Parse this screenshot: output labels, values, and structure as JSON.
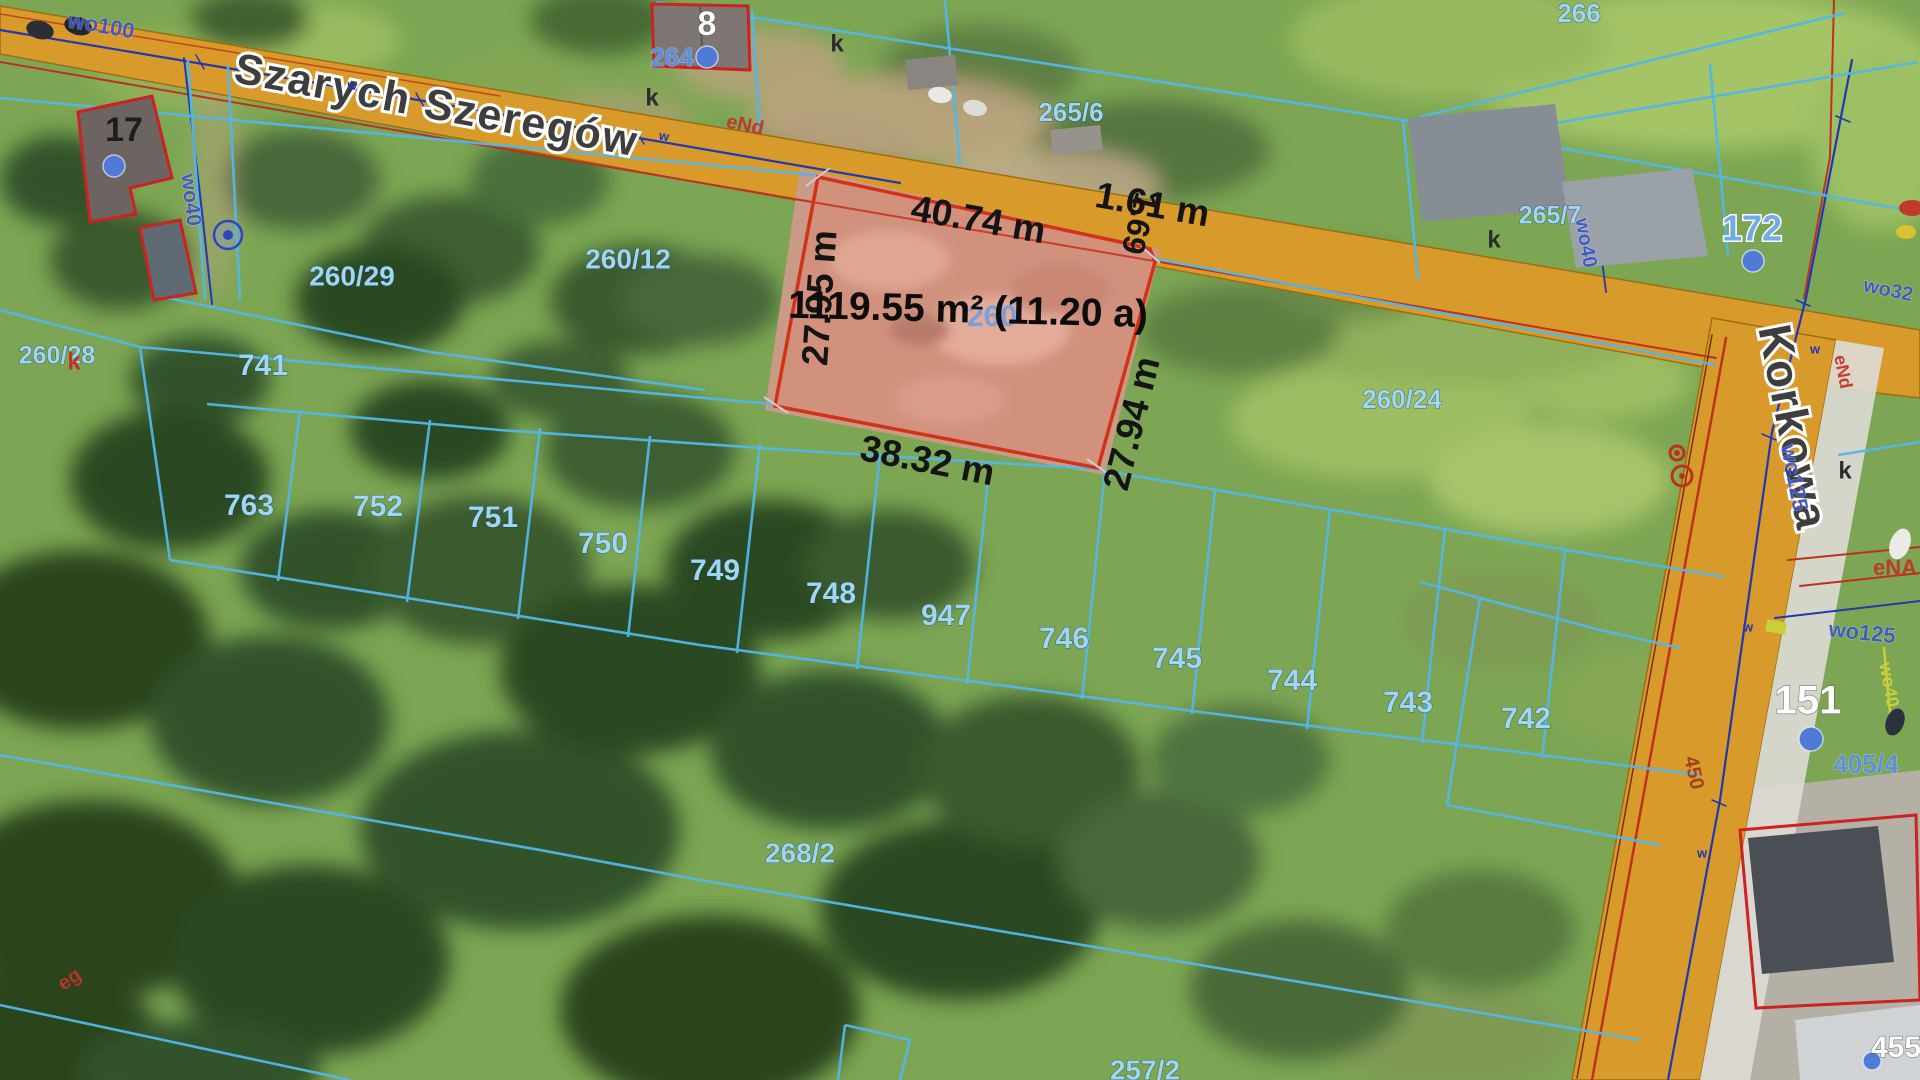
{
  "map": {
    "kind": "cadastral-aerial-map",
    "streets": [
      {
        "name": "Szarych Szeregów"
      },
      {
        "name": "Korkowa"
      }
    ],
    "highlight_parcel": {
      "area_label": "1119.55 m² (11.20 a)",
      "edge_lengths": [
        "40.74 m",
        "1.61 m",
        "1.69",
        "27.95 m",
        "27.94 m",
        "38.32 m"
      ]
    },
    "parcel_numbers": [
      "260/29",
      "260/12",
      "260/28",
      "260/24",
      "741",
      "763",
      "752",
      "751",
      "750",
      "749",
      "748",
      "747",
      "746",
      "745",
      "744",
      "743",
      "742",
      "268/2",
      "257/2",
      "265/6",
      "265/7",
      "266",
      "264",
      "405/4",
      "260"
    ],
    "address_numbers": [
      "17",
      "8",
      "172",
      "151",
      "455"
    ],
    "utility_codes": [
      "wo100",
      "wo40",
      "wo32",
      "wo125",
      "eNA",
      "eNd",
      "eg",
      "450",
      "w",
      "k"
    ]
  },
  "colors": {
    "road_fill": "#d89a2b",
    "road_edge": "#9c6f10",
    "sidewalk": "#dedcd6",
    "parcel_line": "#53b7e8",
    "highlight_stroke": "#d23318",
    "highlight_fill": "rgba(235,115,100,0.22)",
    "soil_fill": "#c99a85",
    "water_line": "#2038b0",
    "power_line": "#c0311c",
    "power_dark": "#7c2d12",
    "gas_line": "#c9cf3a",
    "tick_gray": "#cfcfcf",
    "address_dot": "#5079d8"
  },
  "labels": [
    {
      "name": "street-label-szarych-szeregow",
      "text": "Szarych Szeregów",
      "x": 436,
      "y": 108,
      "r": 10.5,
      "s": 43,
      "cls": "street"
    },
    {
      "name": "street-label-korkowa",
      "text": "Korkowa",
      "x": 1790,
      "y": 428,
      "r": 79,
      "s": 46,
      "cls": "street"
    },
    {
      "name": "parcel-label-260-7-hidden",
      "text": "260",
      "x": 992,
      "y": 318,
      "r": 0,
      "s": 30,
      "cls": "parcel-faint"
    },
    {
      "name": "measurement-top-edge",
      "text": "40.74 m",
      "x": 978,
      "y": 222,
      "r": 10,
      "s": 37,
      "cls": "meas"
    },
    {
      "name": "measurement-161",
      "text": "1.61 m",
      "x": 1152,
      "y": 207,
      "r": 10,
      "s": 37,
      "cls": "meas"
    },
    {
      "name": "measurement-169",
      "text": "1.69",
      "x": 1137,
      "y": 223,
      "r": 104,
      "s": 32,
      "cls": "meas"
    },
    {
      "name": "measurement-right-edge",
      "text": "27.94 m",
      "x": 1134,
      "y": 424,
      "r": -76,
      "s": 37,
      "cls": "meas"
    },
    {
      "name": "measurement-left-edge",
      "text": "27.95 m",
      "x": 822,
      "y": 298,
      "r": -86,
      "s": 37,
      "cls": "meas"
    },
    {
      "name": "measurement-bottom-edge",
      "text": "38.32 m",
      "x": 927,
      "y": 463,
      "r": 11,
      "s": 37,
      "cls": "meas"
    },
    {
      "name": "area-label",
      "text": "1119.55 m² (11.20 a)",
      "x": 968,
      "y": 312,
      "r": 1.5,
      "s": 39,
      "cls": "area"
    },
    {
      "name": "parcel-label-260-29",
      "text": "260/29",
      "x": 352,
      "y": 278,
      "r": 0,
      "s": 28,
      "cls": "parcel"
    },
    {
      "name": "parcel-label-260-12",
      "text": "260/12",
      "x": 628,
      "y": 261,
      "r": 0,
      "s": 28,
      "cls": "parcel"
    },
    {
      "name": "parcel-label-260-28",
      "text": "260/28",
      "x": 57,
      "y": 357,
      "r": 0,
      "s": 25,
      "cls": "parcel"
    },
    {
      "name": "parcel-label-260-24",
      "text": "260/24",
      "x": 1402,
      "y": 401,
      "r": 0,
      "s": 26,
      "cls": "parcel"
    },
    {
      "name": "parcel-label-741",
      "text": "741",
      "x": 263,
      "y": 367,
      "r": 0,
      "s": 30,
      "cls": "parcel"
    },
    {
      "name": "parcel-label-763",
      "text": "763",
      "x": 249,
      "y": 507,
      "r": 0,
      "s": 30,
      "cls": "parcel"
    },
    {
      "name": "parcel-label-752",
      "text": "752",
      "x": 378,
      "y": 508,
      "r": 0,
      "s": 30,
      "cls": "parcel"
    },
    {
      "name": "parcel-label-751",
      "text": "751",
      "x": 493,
      "y": 519,
      "r": 0,
      "s": 30,
      "cls": "parcel"
    },
    {
      "name": "parcel-label-750",
      "text": "750",
      "x": 603,
      "y": 545,
      "r": 0,
      "s": 30,
      "cls": "parcel"
    },
    {
      "name": "parcel-label-749",
      "text": "749",
      "x": 715,
      "y": 572,
      "r": 0,
      "s": 30,
      "cls": "parcel"
    },
    {
      "name": "parcel-label-748",
      "text": "748",
      "x": 831,
      "y": 595,
      "r": 0,
      "s": 30,
      "cls": "parcel"
    },
    {
      "name": "parcel-label-747",
      "text": "947",
      "x": 946,
      "y": 617,
      "r": 0,
      "s": 30,
      "cls": "parcel"
    },
    {
      "name": "parcel-label-746",
      "text": "746",
      "x": 1064,
      "y": 640,
      "r": 0,
      "s": 30,
      "cls": "parcel"
    },
    {
      "name": "parcel-label-745",
      "text": "745",
      "x": 1177,
      "y": 660,
      "r": 0,
      "s": 30,
      "cls": "parcel"
    },
    {
      "name": "parcel-label-744",
      "text": "744",
      "x": 1292,
      "y": 682,
      "r": 0,
      "s": 30,
      "cls": "parcel"
    },
    {
      "name": "parcel-label-743",
      "text": "743",
      "x": 1408,
      "y": 704,
      "r": 0,
      "s": 30,
      "cls": "parcel"
    },
    {
      "name": "parcel-label-742",
      "text": "742",
      "x": 1526,
      "y": 720,
      "r": 0,
      "s": 30,
      "cls": "parcel"
    },
    {
      "name": "parcel-label-268-2",
      "text": "268/2",
      "x": 800,
      "y": 855,
      "r": 0,
      "s": 28,
      "cls": "parcel"
    },
    {
      "name": "parcel-label-257-2",
      "text": "257/2",
      "x": 1145,
      "y": 1072,
      "r": 0,
      "s": 28,
      "cls": "parcel"
    },
    {
      "name": "parcel-label-265-6",
      "text": "265/6",
      "x": 1071,
      "y": 114,
      "r": 0,
      "s": 26,
      "cls": "parcel"
    },
    {
      "name": "parcel-label-265-7",
      "text": "265/7",
      "x": 1550,
      "y": 217,
      "r": 0,
      "s": 25,
      "cls": "parcel"
    },
    {
      "name": "parcel-label-266",
      "text": "266",
      "x": 1579,
      "y": 15,
      "r": 0,
      "s": 26,
      "cls": "parcel"
    },
    {
      "name": "parcel-label-264",
      "text": "264",
      "x": 672,
      "y": 59,
      "r": 0,
      "s": 26,
      "cls": "parcel-strong"
    },
    {
      "name": "parcel-label-405-4",
      "text": "405/4",
      "x": 1866,
      "y": 766,
      "r": 0,
      "s": 26,
      "cls": "parcel-strong"
    },
    {
      "name": "address-label-17",
      "text": "17",
      "x": 124,
      "y": 132,
      "r": 0,
      "s": 34,
      "cls": "addr-dark"
    },
    {
      "name": "address-label-8",
      "text": "8",
      "x": 707,
      "y": 26,
      "r": 0,
      "s": 34,
      "cls": "addr-white"
    },
    {
      "name": "address-label-172",
      "text": "172",
      "x": 1752,
      "y": 231,
      "r": 0,
      "s": 36,
      "cls": "addr-blue"
    },
    {
      "name": "address-label-151",
      "text": "151",
      "x": 1808,
      "y": 703,
      "r": 0,
      "s": 40,
      "cls": "addr-white"
    },
    {
      "name": "address-label-455",
      "text": "455",
      "x": 1896,
      "y": 1049,
      "r": 0,
      "s": 30,
      "cls": "addr-white"
    },
    {
      "name": "utility-label-wo100",
      "text": "wo100",
      "x": 101,
      "y": 27,
      "r": 10,
      "s": 22,
      "cls": "util-blue"
    },
    {
      "name": "utility-label-wo40-left",
      "text": "wo40",
      "x": 190,
      "y": 200,
      "r": 83,
      "s": 21,
      "cls": "util-blue"
    },
    {
      "name": "utility-label-wo40-korkowa",
      "text": "wo40",
      "x": 1585,
      "y": 243,
      "r": 80,
      "s": 20,
      "cls": "util-blue"
    },
    {
      "name": "utility-label-wo32",
      "text": "wo32",
      "x": 1888,
      "y": 291,
      "r": 12,
      "s": 20,
      "cls": "util-blue"
    },
    {
      "name": "utility-label-wo125-road",
      "text": "wo125",
      "x": 1793,
      "y": 478,
      "r": 79,
      "s": 22,
      "cls": "util-blue"
    },
    {
      "name": "utility-label-wo125-east",
      "text": "wo125",
      "x": 1862,
      "y": 634,
      "r": 6,
      "s": 22,
      "cls": "util-blue"
    },
    {
      "name": "utility-label-ena",
      "text": "eNA",
      "x": 1895,
      "y": 569,
      "r": 0,
      "s": 22,
      "cls": "util-red"
    },
    {
      "name": "utility-label-end-road",
      "text": "eNd",
      "x": 1842,
      "y": 372,
      "r": 79,
      "s": 18,
      "cls": "util-red"
    },
    {
      "name": "utility-label-end-top",
      "text": "eNd",
      "x": 745,
      "y": 126,
      "r": 12,
      "s": 20,
      "cls": "util-red"
    },
    {
      "name": "utility-label-eg",
      "text": "eg",
      "x": 70,
      "y": 980,
      "r": -35,
      "s": 20,
      "cls": "util-red"
    },
    {
      "name": "utility-label-450",
      "text": "450",
      "x": 1693,
      "y": 773,
      "r": 78,
      "s": 20,
      "cls": "util-darkred"
    },
    {
      "name": "utility-label-wo40-gas",
      "text": "wo40",
      "x": 1888,
      "y": 685,
      "r": 80,
      "s": 18,
      "cls": "util-yellow"
    },
    {
      "name": "surface-marker-k-1",
      "text": "k",
      "x": 652,
      "y": 99,
      "r": 0,
      "s": 24,
      "cls": "mark-dark"
    },
    {
      "name": "surface-marker-k-2",
      "text": "k",
      "x": 837,
      "y": 45,
      "r": 0,
      "s": 24,
      "cls": "mark-dark"
    },
    {
      "name": "surface-marker-k-3",
      "text": "k",
      "x": 1494,
      "y": 241,
      "r": 0,
      "s": 24,
      "cls": "mark-dark"
    },
    {
      "name": "surface-marker-k-4",
      "text": "k",
      "x": 1845,
      "y": 472,
      "r": 0,
      "s": 24,
      "cls": "mark-dark"
    },
    {
      "name": "surface-marker-k-red",
      "text": "k",
      "x": 74,
      "y": 363,
      "r": 0,
      "s": 24,
      "cls": "mark-red"
    },
    {
      "name": "water-mark-w-1",
      "text": "w",
      "x": 352,
      "y": 86,
      "r": 10,
      "s": 13,
      "cls": "w-mark"
    },
    {
      "name": "water-mark-w-2",
      "text": "w",
      "x": 664,
      "y": 137,
      "r": 10,
      "s": 13,
      "cls": "w-mark"
    },
    {
      "name": "water-mark-w-3",
      "text": "w",
      "x": 1815,
      "y": 350,
      "r": 0,
      "s": 13,
      "cls": "w-mark"
    },
    {
      "name": "water-mark-w-4",
      "text": "w",
      "x": 1790,
      "y": 472,
      "r": 0,
      "s": 13,
      "cls": "w-mark"
    },
    {
      "name": "water-mark-w-5",
      "text": "w",
      "x": 1748,
      "y": 628,
      "r": 0,
      "s": 13,
      "cls": "w-mark"
    },
    {
      "name": "water-mark-w-6",
      "text": "w",
      "x": 1702,
      "y": 854,
      "r": 0,
      "s": 13,
      "cls": "w-mark"
    }
  ],
  "symbols": [
    {
      "type": "address-dot",
      "name": "address-dot-17",
      "x": 114,
      "y": 166,
      "r": 11
    },
    {
      "type": "address-dot",
      "name": "address-dot-8",
      "x": 707,
      "y": 57,
      "r": 11
    },
    {
      "type": "address-dot",
      "name": "address-dot-172",
      "x": 1753,
      "y": 261,
      "r": 11
    },
    {
      "type": "address-dot",
      "name": "address-dot-151",
      "x": 1811,
      "y": 739,
      "r": 12
    },
    {
      "type": "address-dot",
      "name": "address-dot-455",
      "x": 1872,
      "y": 1061,
      "r": 9
    },
    {
      "type": "well",
      "name": "well-symbol",
      "x": 228,
      "y": 235,
      "r": 14
    },
    {
      "type": "hydrant",
      "name": "hydrant-symbol",
      "x": 1682,
      "y": 476,
      "r": 10
    },
    {
      "type": "hydrant",
      "name": "hydrant-symbol-small",
      "x": 1677,
      "y": 453,
      "r": 7
    },
    {
      "type": "marker-box",
      "name": "utility-marker-box",
      "x": 1776,
      "y": 627,
      "w": 20,
      "h": 12
    }
  ]
}
